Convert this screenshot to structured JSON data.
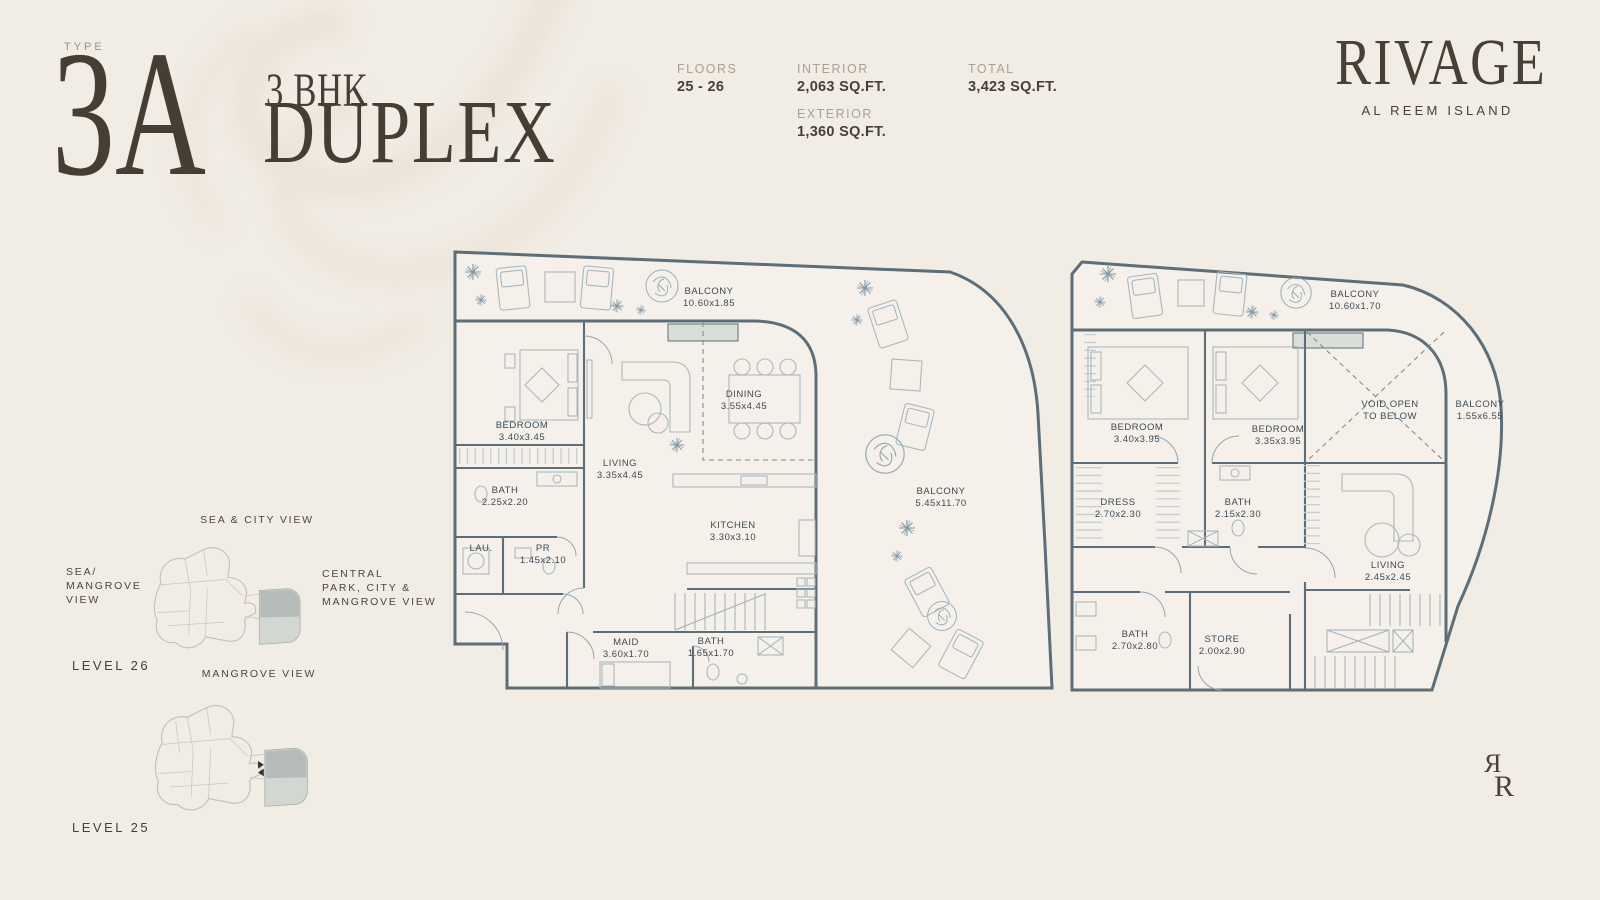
{
  "colors": {
    "background": "#f1ece4",
    "ink": "#474039",
    "muted_label": "#a8a195",
    "plan_line": "#5d6e78",
    "room_label": "#3d4a53",
    "keyplan_highlight_dark": "#b6bcba",
    "keyplan_highlight_light": "#d3d7d2"
  },
  "header": {
    "type_label": "TYPE",
    "type_value": "3A",
    "subtitle_line1": "3 BHK",
    "subtitle_line2": "DUPLEX"
  },
  "stats": {
    "floors": {
      "label": "FLOORS",
      "value": "25 - 26"
    },
    "interior": {
      "label": "INTERIOR",
      "value": "2,063 SQ.FT."
    },
    "exterior": {
      "label": "EXTERIOR",
      "value": "1,360 SQ.FT."
    },
    "total": {
      "label": "TOTAL",
      "value": "3,423 SQ.FT."
    }
  },
  "brand": {
    "name": "RIVAGE",
    "location": "AL REEM ISLAND",
    "monogram_left": "Я",
    "monogram_right": "R"
  },
  "keyplan": {
    "view_top": "SEA & CITY VIEW",
    "view_left_lines": [
      "SEA/",
      "MANGROVE",
      "VIEW"
    ],
    "view_right_lines": [
      "CENTRAL",
      "PARK, CITY &",
      "MANGROVE VIEW"
    ],
    "view_bottom": "MANGROVE VIEW",
    "level_upper": "LEVEL 26",
    "level_lower": "LEVEL 25"
  },
  "plans": {
    "lower": {
      "rooms": [
        {
          "id": "balcony-top",
          "lines": [
            "BALCONY",
            "10.60x1.85"
          ]
        },
        {
          "id": "bedroom",
          "lines": [
            "BEDROOM",
            "3.40x3.45"
          ]
        },
        {
          "id": "bath",
          "lines": [
            "BATH",
            "2.25x2.20"
          ]
        },
        {
          "id": "laundry",
          "lines": [
            "LAU."
          ]
        },
        {
          "id": "powder-room",
          "lines": [
            "PR",
            "1.45x2.10"
          ]
        },
        {
          "id": "living",
          "lines": [
            "LIVING",
            "3.35x4.45"
          ]
        },
        {
          "id": "dining",
          "lines": [
            "DINING",
            "3.55x4.45"
          ]
        },
        {
          "id": "kitchen",
          "lines": [
            "KITCHEN",
            "3.30x3.10"
          ]
        },
        {
          "id": "maid",
          "lines": [
            "MAID",
            "3.60x1.70"
          ]
        },
        {
          "id": "bath-2",
          "lines": [
            "BATH",
            "1.65x1.70"
          ]
        },
        {
          "id": "balcony-side",
          "lines": [
            "BALCONY",
            "5.45x11.70"
          ]
        }
      ]
    },
    "upper": {
      "rooms": [
        {
          "id": "balcony-top",
          "lines": [
            "BALCONY",
            "10.60x1.70"
          ]
        },
        {
          "id": "bedroom-1",
          "lines": [
            "BEDROOM",
            "3.40x3.95"
          ]
        },
        {
          "id": "bedroom-2",
          "lines": [
            "BEDROOM",
            "3.35x3.95"
          ]
        },
        {
          "id": "void",
          "lines": [
            "VOID OPEN",
            "TO BELOW"
          ]
        },
        {
          "id": "balcony-side",
          "lines": [
            "BALCONY",
            "1.55x6.55"
          ]
        },
        {
          "id": "dress",
          "lines": [
            "DRESS",
            "2.70x2.30"
          ]
        },
        {
          "id": "bath-1",
          "lines": [
            "BATH",
            "2.15x2.30"
          ]
        },
        {
          "id": "living",
          "lines": [
            "LIVING",
            "2.45x2.45"
          ]
        },
        {
          "id": "bath-2",
          "lines": [
            "BATH",
            "2.70x2.80"
          ]
        },
        {
          "id": "store",
          "lines": [
            "STORE",
            "2.00x2.90"
          ]
        }
      ]
    }
  }
}
